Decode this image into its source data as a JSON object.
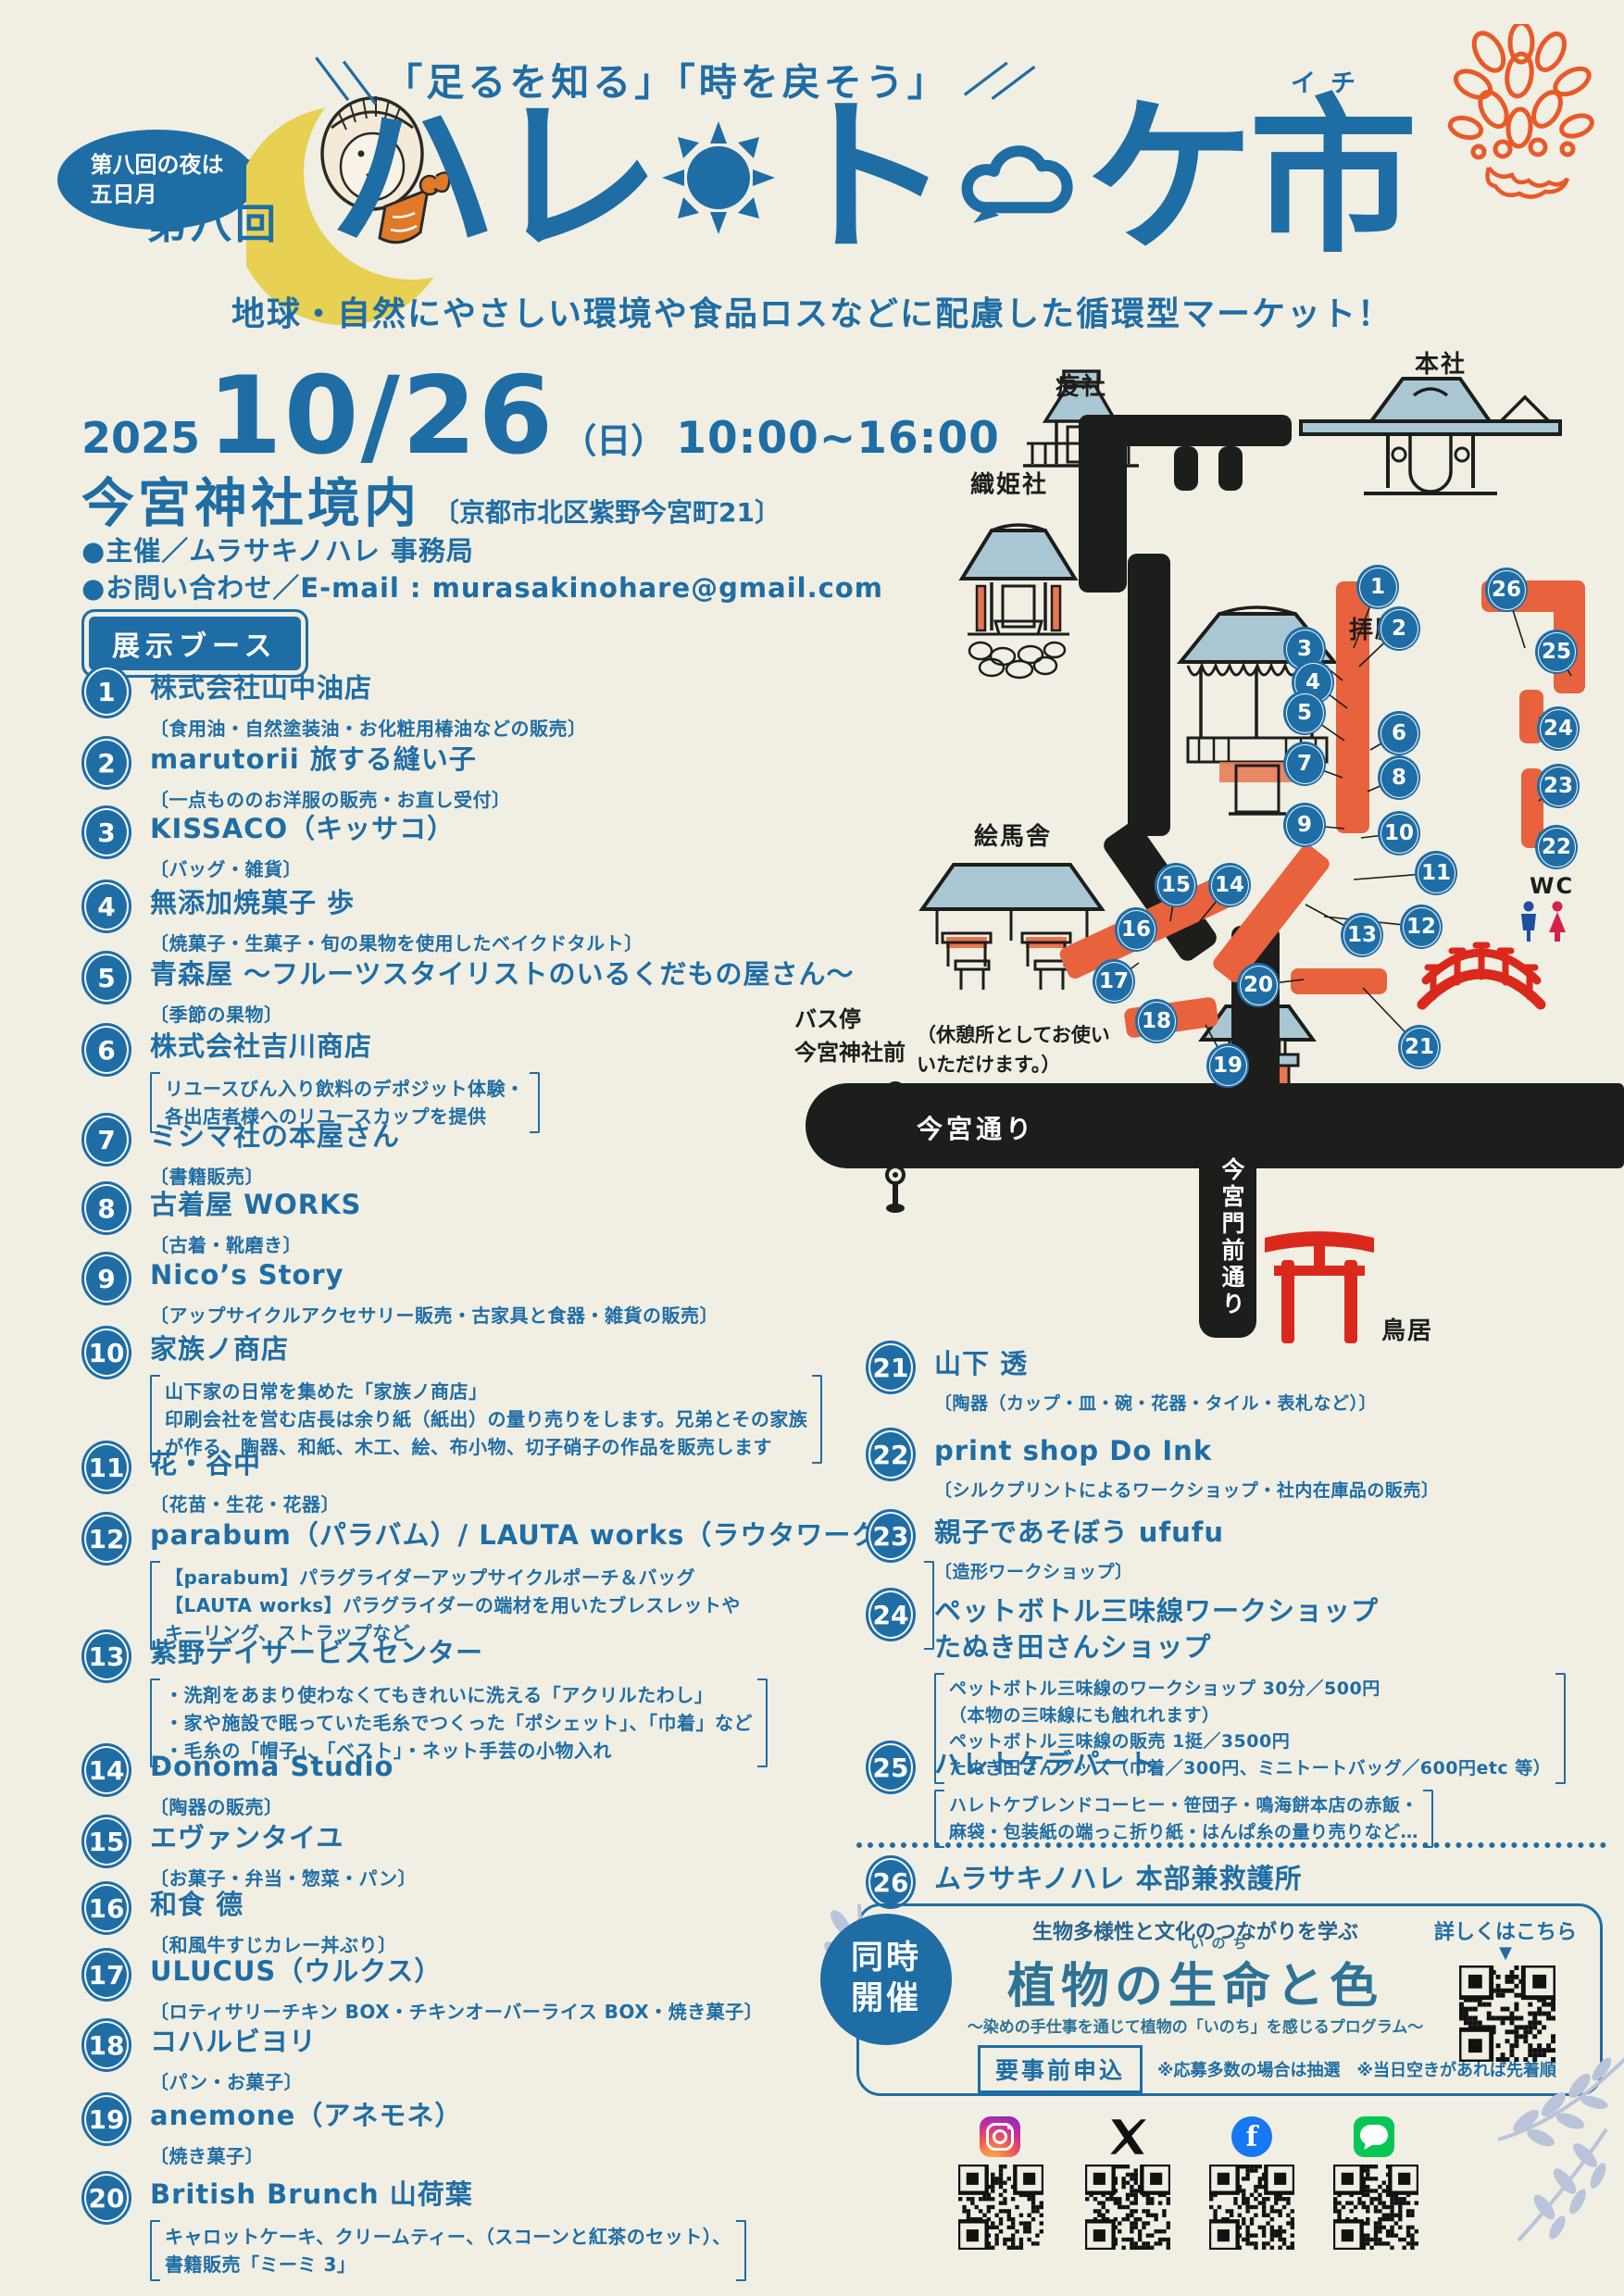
{
  "colors": {
    "blue": "#1f6da5",
    "orange": "#e8623d",
    "red": "#da291c",
    "roof": "#a9c7d2",
    "moon": "#e7d052",
    "cream": "#f1efe3",
    "leaf": "#b9c4da"
  },
  "header": {
    "bubble": "第八回の夜は\n五日月",
    "edition": "第八回",
    "tagline": "「足るを知る」「時を戻そう」",
    "slash_left": "＼＼",
    "slash_right": "／／",
    "title_1": "ハ",
    "title_2": "レ",
    "title_3": "ト",
    "title_4": "ケ",
    "title_5": "市",
    "title_furigana": "イチ",
    "subtitle": "地球・自然にやさしい環境や食品ロスなどに配慮した循環型マーケット！"
  },
  "event": {
    "year": "2025",
    "date": "10/26",
    "day": "（日）",
    "time": "10:00~16:00",
    "venue": "今宮神社境内",
    "address": "〔京都市北区紫野今宮町21〕",
    "organizer": "●主催／ムラサキノハレ 事務局",
    "contact": "●お問い合わせ／E-mail : murasakinohare@gmail.com",
    "booth_badge": "展示ブース"
  },
  "booths": [
    {
      "num": "1",
      "name": "株式会社山中油店",
      "desc": [
        "食用油・自然塗装油・お化粧用椿油などの販売"
      ]
    },
    {
      "num": "2",
      "name": "marutorii 旅する縫い子",
      "desc": [
        "一点もののお洋服の販売・お直し受付"
      ]
    },
    {
      "num": "3",
      "name": "KISSACO（キッサコ）",
      "desc": [
        "バッグ・雑貨"
      ]
    },
    {
      "num": "4",
      "name": "無添加焼菓子 歩",
      "desc": [
        "焼菓子・生菓子・旬の果物を使用したベイクドタルト"
      ]
    },
    {
      "num": "5",
      "name": "青森屋 ～フルーツスタイリストのいるくだもの屋さん～",
      "desc": [
        "季節の果物"
      ]
    },
    {
      "num": "6",
      "name": "株式会社吉川商店",
      "desc": [
        "リユースびん入り飲料のデポジット体験・",
        "各出店者様へのリユースカップを提供"
      ]
    },
    {
      "num": "7",
      "name": "ミシマ社の本屋さん",
      "desc": [
        "書籍販売"
      ]
    },
    {
      "num": "8",
      "name": "古着屋 WORKS",
      "desc": [
        "古着・靴磨き"
      ]
    },
    {
      "num": "9",
      "name": "Nico’s Story",
      "desc": [
        "アップサイクルアクセサリー販売・古家具と食器・雑貨の販売"
      ]
    },
    {
      "num": "10",
      "name": "家族ノ商店",
      "desc": [
        "山下家の日常を集めた「家族ノ商店」",
        "印刷会社を営む店長は余り紙（紙出）の量り売りをします。兄弟とその家族",
        "が作る、陶器、和紙、木工、絵、布小物、切子硝子の作品を販売します"
      ]
    },
    {
      "num": "11",
      "name": "花・谷中",
      "desc": [
        "花苗・生花・花器"
      ]
    },
    {
      "num": "12",
      "name": "parabum（パラバム）/ LAUTA works（ラウタワークス）",
      "desc": [
        "【parabum】パラグライダーアップサイクルポーチ＆バッグ",
        "【LAUTA works】パラグライダーの端材を用いたブレスレットや",
        "キーリング、ストラップなど"
      ]
    },
    {
      "num": "13",
      "name": "紫野デイサービスセンター",
      "desc": [
        "・洗剤をあまり使わなくてもきれいに洗える「アクリルたわし」",
        "・家や施設で眠っていた毛糸でつくった「ポシェット」、「巾着」など",
        "・毛糸の「帽子」、「ベスト」・ネット手芸の小物入れ"
      ]
    },
    {
      "num": "14",
      "name": "Donoma Studio",
      "desc": [
        "陶器の販売"
      ]
    },
    {
      "num": "15",
      "name": "エヴァンタイユ",
      "desc": [
        "お菓子・弁当・惣菜・パン"
      ]
    },
    {
      "num": "16",
      "name": "和食 德",
      "desc": [
        "和風牛すじカレー丼ぶり"
      ]
    },
    {
      "num": "17",
      "name": "ULUCUS（ウルクス）",
      "desc": [
        "ロティサリーチキン BOX・チキンオーバーライス BOX・焼き菓子"
      ]
    },
    {
      "num": "18",
      "name": "コハルビヨリ",
      "desc": [
        "パン・お菓子"
      ]
    },
    {
      "num": "19",
      "name": "anemone（アネモネ）",
      "desc": [
        "焼き菓子"
      ]
    },
    {
      "num": "20",
      "name": "British Brunch 山荷葉",
      "desc": [
        "キャロットケーキ、クリームティー、（スコーンと紅茶のセット）、",
        "書籍販売「ミーミ 3」"
      ]
    },
    {
      "num": "21",
      "name": "山下 透",
      "desc": [
        "陶器（カップ・皿・碗・花器・タイル・表札など）"
      ]
    },
    {
      "num": "22",
      "name": "print shop Do Ink",
      "desc": [
        "シルクプリントによるワークショップ・社内在庫品の販売"
      ]
    },
    {
      "num": "23",
      "name": "親子であそぼう ufufu",
      "desc": [
        "造形ワークショップ"
      ]
    },
    {
      "num": "24",
      "name": "ペットボトル三味線ワークショップ\nたぬき田さんショップ",
      "desc": [
        "ペットボトル三味線のワークショップ 30分／500円",
        "（本物の三味線にも触れれます）",
        "ペットボトル三味線の販売 1挺／3500円",
        "たぬき田さんグッズ（巾着／300円、ミニトートバッグ／600円etc 等）"
      ]
    },
    {
      "num": "25",
      "name": "ハレトケデパート",
      "desc": [
        "ハレトケブレンドコーヒー・笹団子・鳴海餅本店の赤飯・",
        "麻袋・包装紙の端っこ折り紙・はんぱ糸の量り売りなど…"
      ]
    },
    {
      "num": "26",
      "name": "ムラサキノハレ 本部兼救護所",
      "desc": []
    }
  ],
  "map": {
    "labels": {
      "ekisha": "疫社",
      "honsha": "本社",
      "orihimesha": "織姫社",
      "haiden": "拝殿",
      "emasha": "絵馬舎",
      "rest_note": "（休憩所としてお使い\nいただけます。）",
      "bus_stop": "バス停\n今宮神社前",
      "road_h": "今宮通り",
      "road_v": "今宮門前通り",
      "torii": "鳥居",
      "wc": "WC"
    },
    "points": [
      1,
      2,
      3,
      4,
      5,
      6,
      7,
      8,
      9,
      10,
      11,
      12,
      13,
      14,
      15,
      16,
      17,
      18,
      19,
      20,
      21,
      22,
      23,
      24,
      25,
      26
    ]
  },
  "subevent": {
    "badge": "同時\n開催",
    "lead": "生物多様性と文化のつながりを学ぶ",
    "title_prefix": "植物の",
    "title_base": "生命",
    "title_ruby": "いのち",
    "title_suffix": "と色",
    "tagline": "～染めの手仕事を通じて植物の「いのち」を感じるプログラム～",
    "apply": "要事前申込",
    "note": "※応募多数の場合は抽選　※当日空きがあれば先着順",
    "more": "詳しくはこちら",
    "arrow": "▼"
  },
  "footer": {
    "social": [
      "instagram",
      "x",
      "facebook",
      "line"
    ]
  }
}
